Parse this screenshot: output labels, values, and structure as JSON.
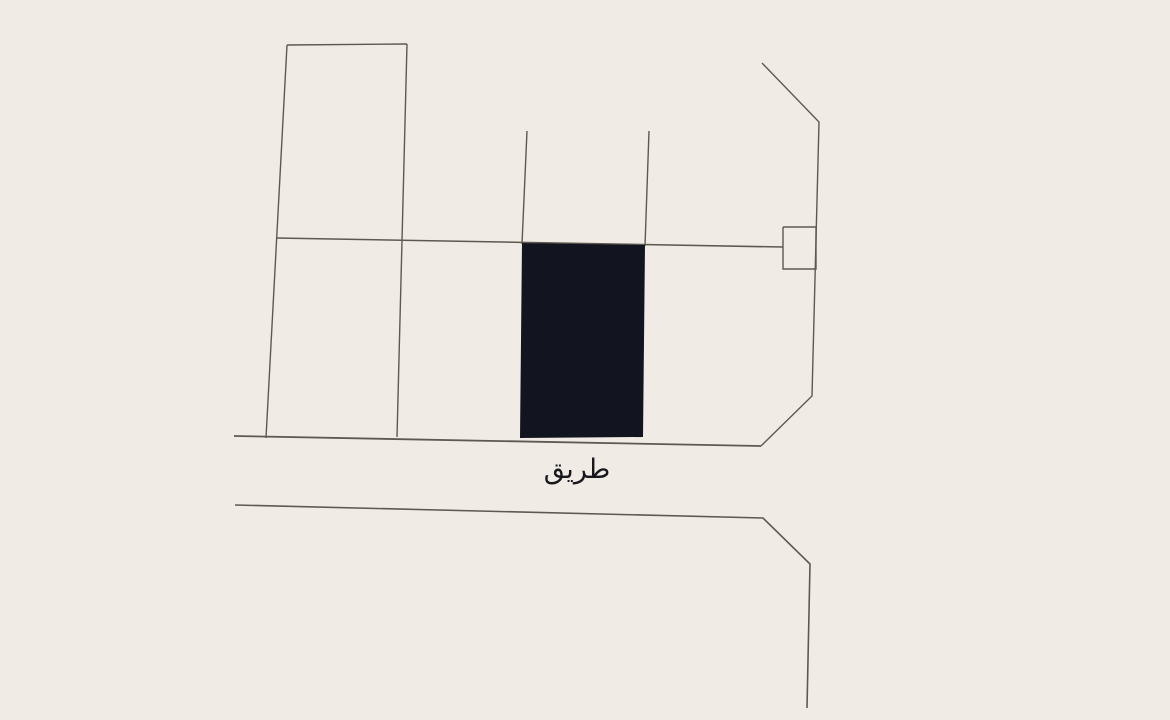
{
  "map": {
    "background_color": "#f0ece5",
    "line_color": "#5d5950",
    "parcel_fill_color": "#121420",
    "road_label": "طريق",
    "road_label_color": "#17171c",
    "road_label_position": {
      "x": 577,
      "y": 478
    },
    "highlighted_parcel": {
      "name": "highlighted-parcel",
      "points": [
        [
          522,
          243
        ],
        [
          645,
          245
        ],
        [
          643,
          437
        ],
        [
          520,
          438
        ]
      ]
    },
    "lines": [
      {
        "name": "parcel-top-edge",
        "w": 1.4,
        "points": [
          [
            287,
            45
          ],
          [
            407,
            44
          ]
        ]
      },
      {
        "name": "parcel-left-edge",
        "w": 1.4,
        "points": [
          [
            287,
            45
          ],
          [
            266,
            438
          ]
        ]
      },
      {
        "name": "parcel-right-edge",
        "w": 1.4,
        "points": [
          [
            407,
            44
          ],
          [
            397,
            437
          ]
        ]
      },
      {
        "name": "block-mid-boundary",
        "w": 1.6,
        "points": [
          [
            276,
            238
          ],
          [
            783,
            247
          ]
        ]
      },
      {
        "name": "lot-line-left",
        "w": 1.4,
        "points": [
          [
            527,
            131
          ],
          [
            522,
            244
          ]
        ]
      },
      {
        "name": "lot-line-right",
        "w": 1.4,
        "points": [
          [
            649,
            131
          ],
          [
            645,
            246
          ]
        ]
      },
      {
        "name": "street-edge-upper-right",
        "w": 1.4,
        "points": [
          [
            762,
            63
          ],
          [
            819,
            122
          ],
          [
            812,
            396
          ],
          [
            761,
            446
          ]
        ]
      },
      {
        "name": "road-upper-edge",
        "w": 1.8,
        "points": [
          [
            234,
            436
          ],
          [
            761,
            446
          ]
        ]
      },
      {
        "name": "road-lower-edge",
        "w": 1.6,
        "points": [
          [
            235,
            505
          ],
          [
            763,
            518
          ],
          [
            810,
            564
          ],
          [
            807,
            708
          ]
        ]
      },
      {
        "name": "utility-box",
        "w": 1.4,
        "points": [
          [
            783,
            227
          ],
          [
            816,
            227
          ],
          [
            816,
            269
          ],
          [
            783,
            269
          ],
          [
            783,
            227
          ]
        ]
      }
    ]
  }
}
